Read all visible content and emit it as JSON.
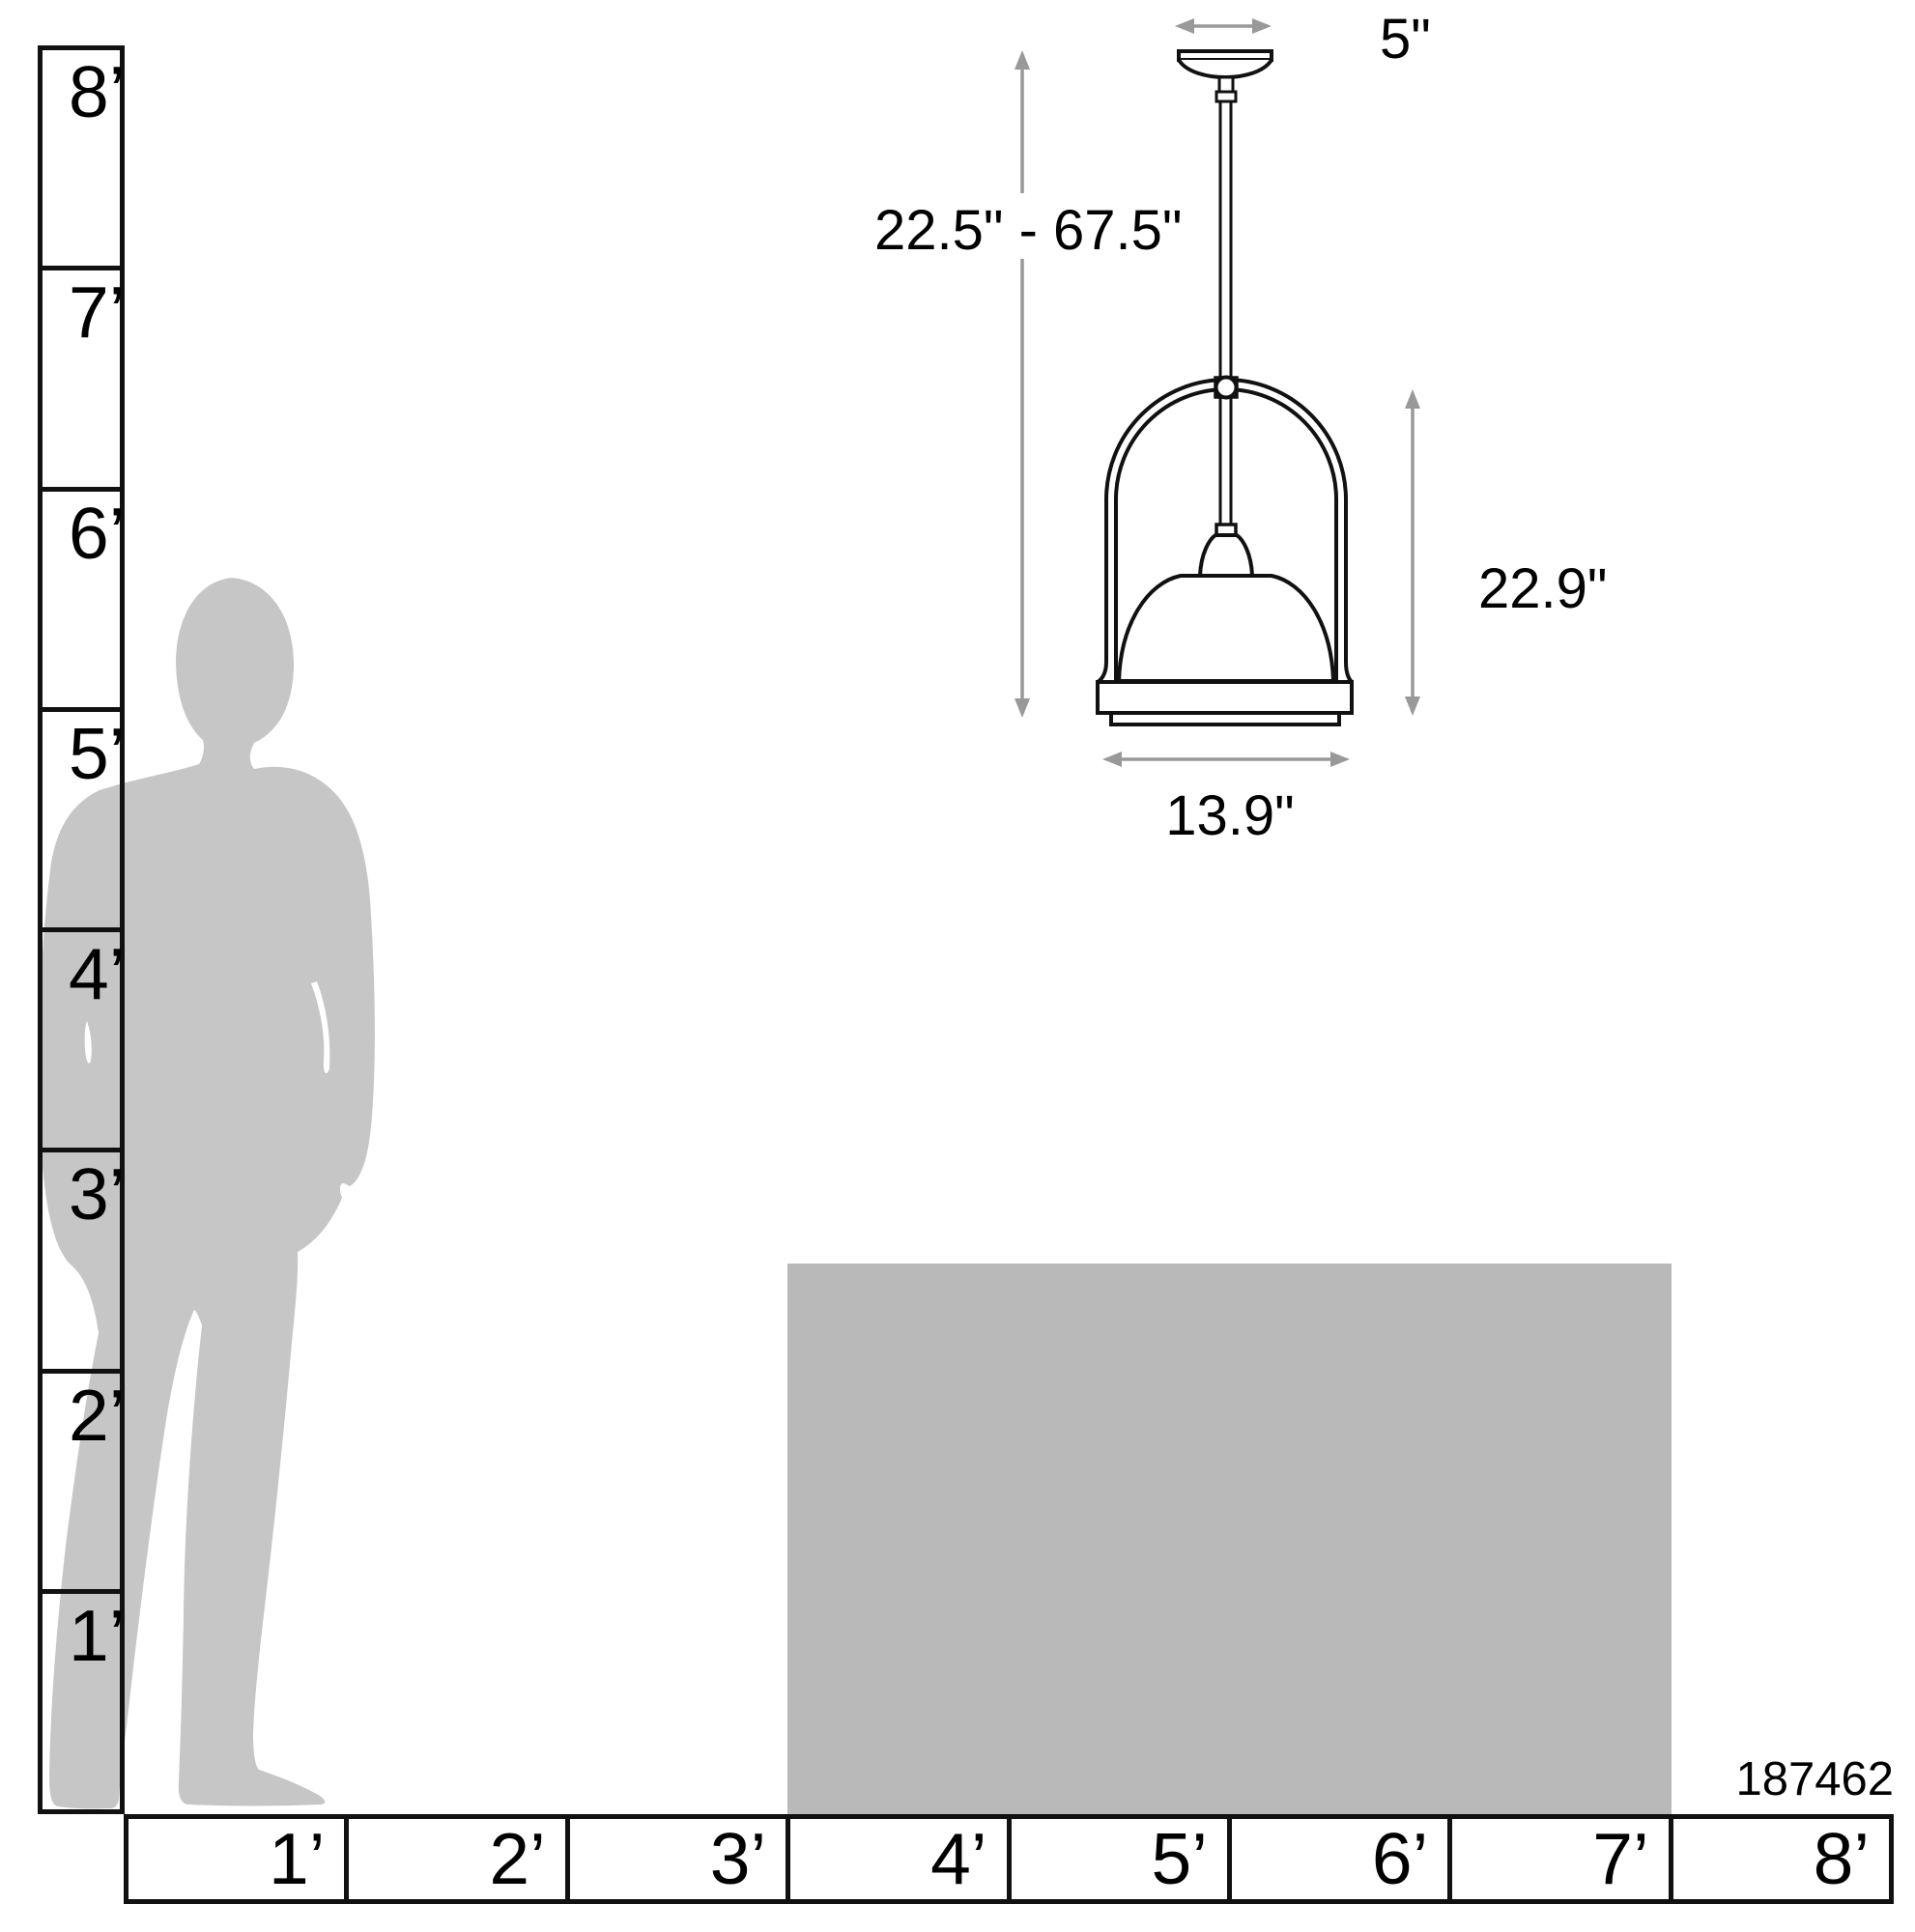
{
  "page": {
    "sku": "187462"
  },
  "dimensions": {
    "canopy_width": "5\"",
    "suspension_height": "22.5\" - 67.5\"",
    "fixture_height": "22.9\"",
    "fixture_width": "13.9\""
  },
  "vertical_ruler": {
    "unit": "feet",
    "labels": [
      "8’",
      "7’",
      "6’",
      "5’",
      "4’",
      "3’",
      "2’",
      "1’"
    ]
  },
  "horizontal_ruler": {
    "unit": "feet",
    "labels": [
      "1’",
      "2’",
      "3’",
      "4’",
      "5’",
      "6’",
      "7’",
      "8’"
    ]
  },
  "colors": {
    "line": "#111111",
    "arrow": "#999999",
    "silhouette": "#c6c6c6",
    "furniture": "#b9b9b9"
  }
}
